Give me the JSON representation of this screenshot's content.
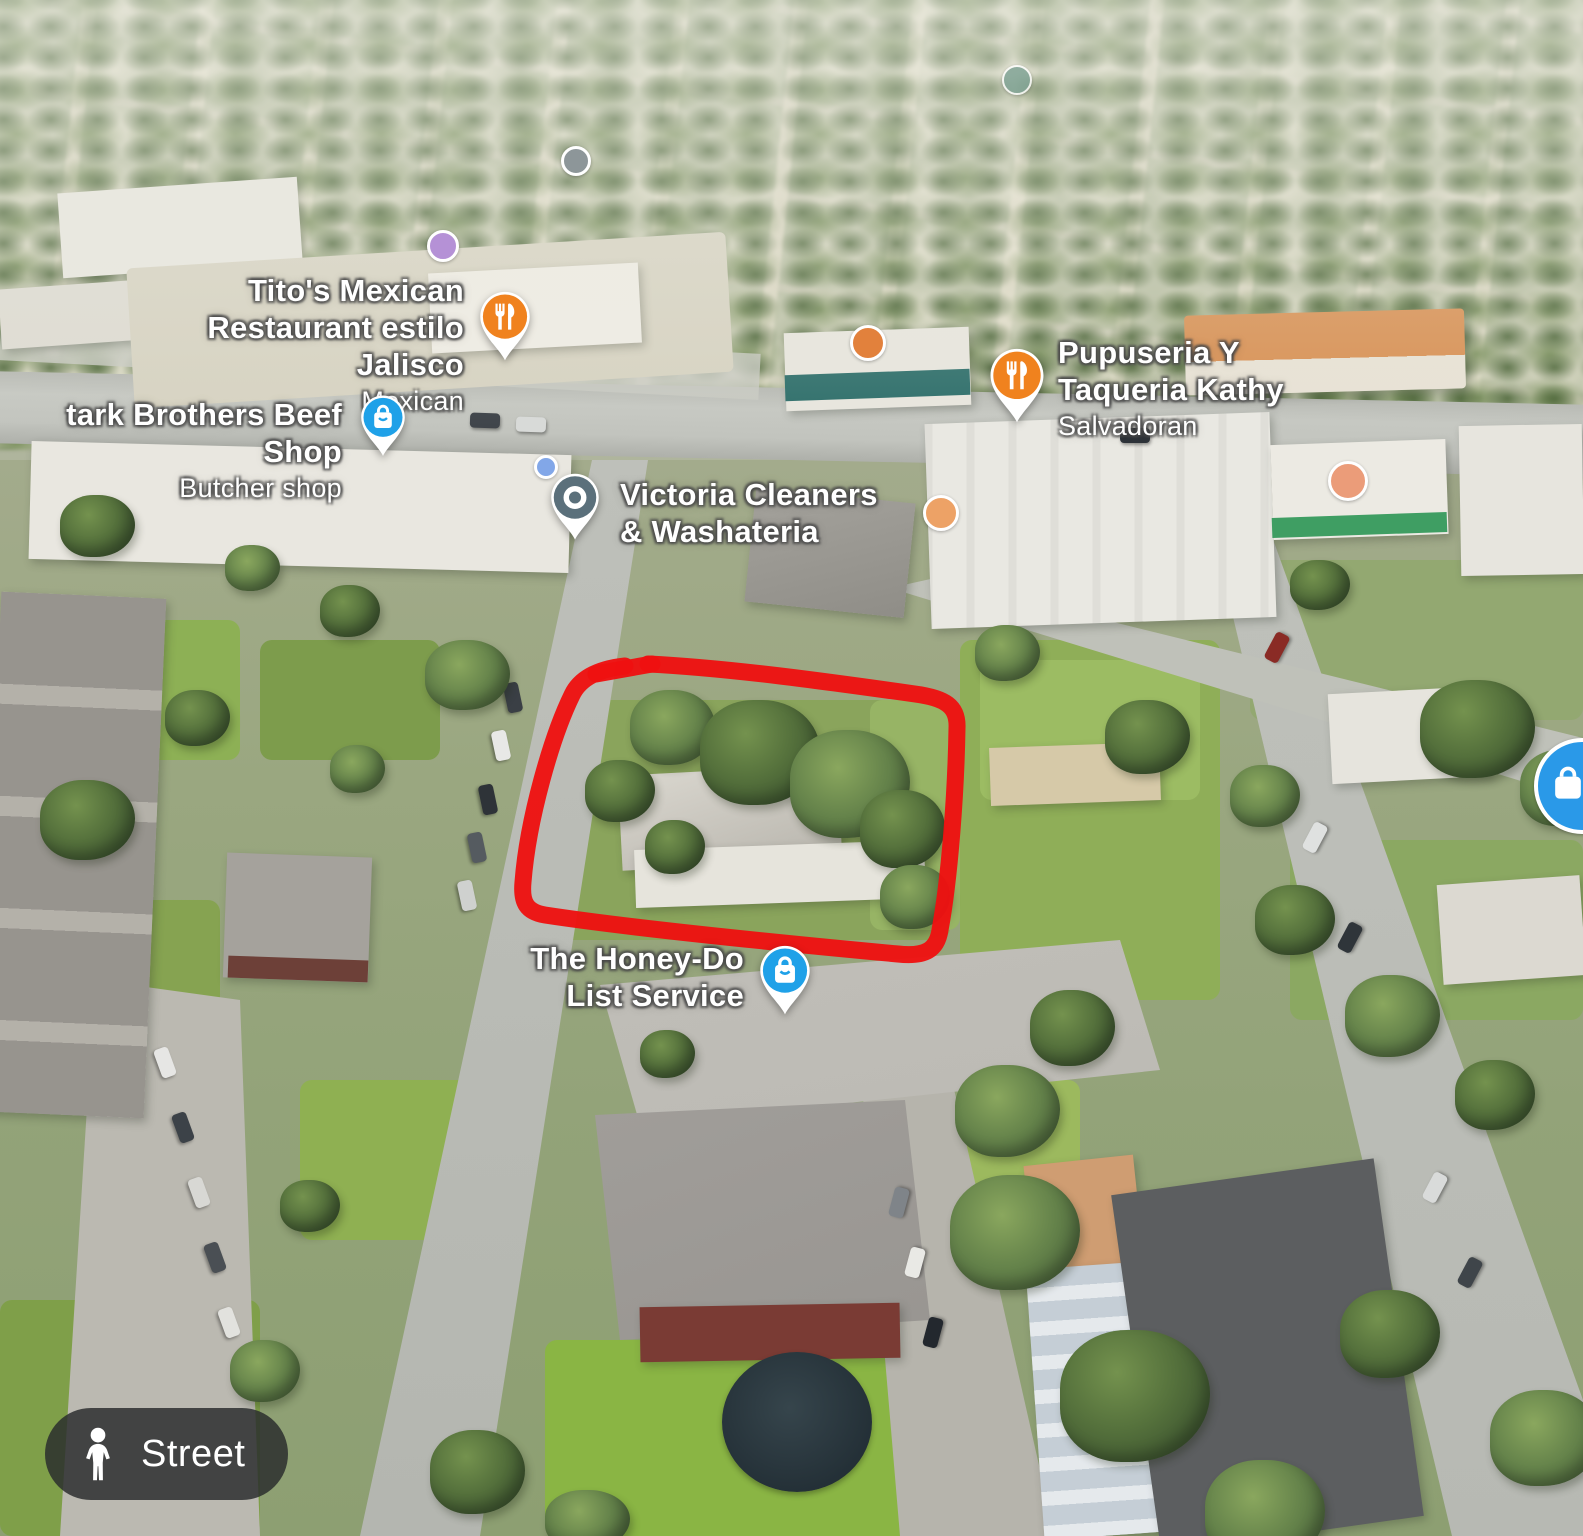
{
  "places": [
    {
      "lines": [
        "Tito's Mexican",
        "Restaurant estilo Jalisco"
      ],
      "category": "Mexican",
      "pin": "restaurant-pin",
      "pin_color": "#F0821E"
    },
    {
      "lines": [
        "tark Brothers Beef Shop"
      ],
      "category": "Butcher shop",
      "pin": "shopping-pin",
      "pin_color": "#1FA1E8"
    },
    {
      "lines": [
        "Victoria Cleaners",
        "& Washateria"
      ],
      "category": "",
      "pin": "generic-place-pin",
      "pin_color": "#5B707B"
    },
    {
      "lines": [
        "Pupuseria Y",
        "Taqueria Kathy"
      ],
      "category": "Salvadoran",
      "pin": "restaurant-pin",
      "pin_color": "#F0821E"
    },
    {
      "lines": [
        "The Honey-Do",
        "List Service"
      ],
      "category": "",
      "pin": "shopping-pin",
      "pin_color": "#1FA1E8"
    }
  ],
  "controls": {
    "street_button_label": "Street",
    "street_button_icon": "pegman-icon"
  },
  "annotation": {
    "type": "hand-drawn-rectangle",
    "color": "#EE1111"
  },
  "minor_markers": [
    {
      "color": "#8D9699"
    },
    {
      "color": "#B591D6"
    },
    {
      "color": "#7BA092"
    },
    {
      "color": "#82A7E8"
    },
    {
      "color": "#E2813C"
    },
    {
      "color": "#EDA266"
    },
    {
      "color": "#EB9C79"
    },
    {
      "color": "#2A99E8"
    }
  ]
}
